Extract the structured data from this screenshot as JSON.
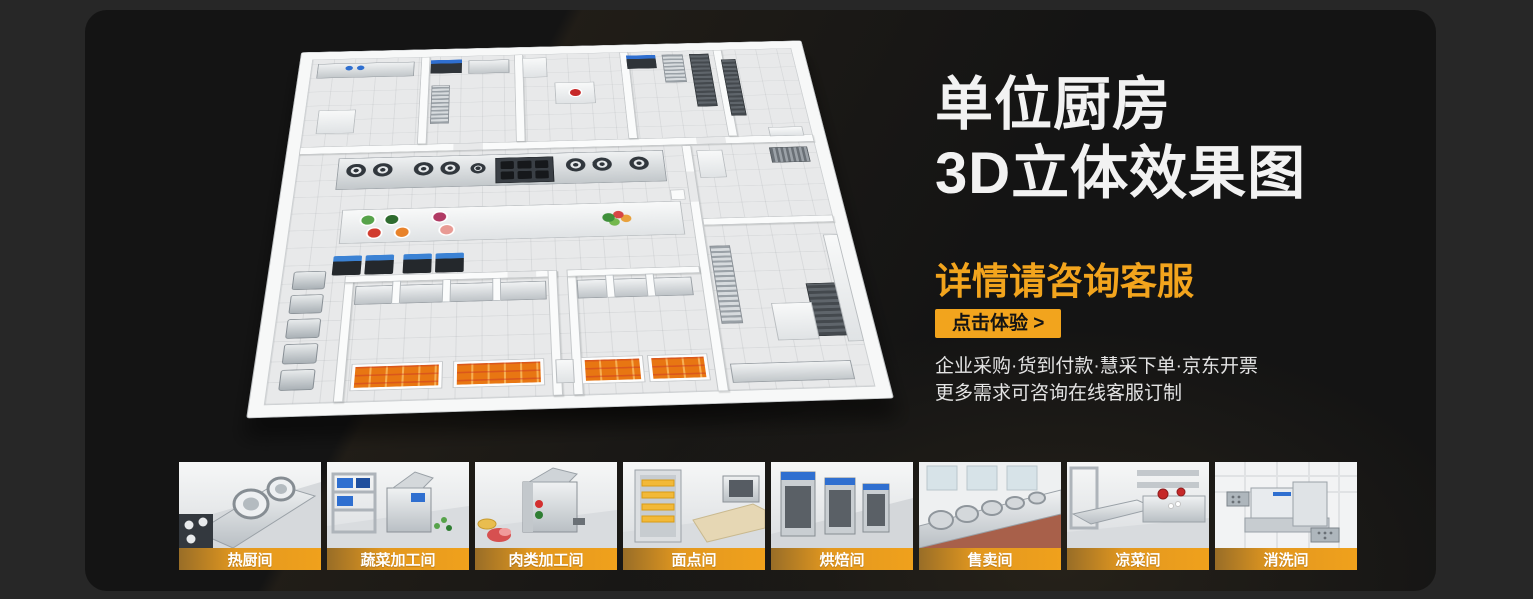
{
  "hero": {
    "title_line1": "单位厨房",
    "title_line2": "3D立体效果图",
    "subtitle": "详情请咨询客服",
    "cta_label": "点击体验 >",
    "info_line1": "企业采购·货到付款·慧采下单·京东开票",
    "info_line2": "更多需求可咨询在线客服订制"
  },
  "colors": {
    "accent": "#F2A41D",
    "card_bg": "#141414",
    "page_bg": "#272727",
    "label_bar": "#F0A11C"
  },
  "gallery": {
    "items": [
      {
        "label": "热厨间"
      },
      {
        "label": "蔬菜加工间"
      },
      {
        "label": "肉类加工间"
      },
      {
        "label": "面点间"
      },
      {
        "label": "烘焙间"
      },
      {
        "label": "售卖间"
      },
      {
        "label": "凉菜间"
      },
      {
        "label": "消洗间"
      }
    ]
  }
}
